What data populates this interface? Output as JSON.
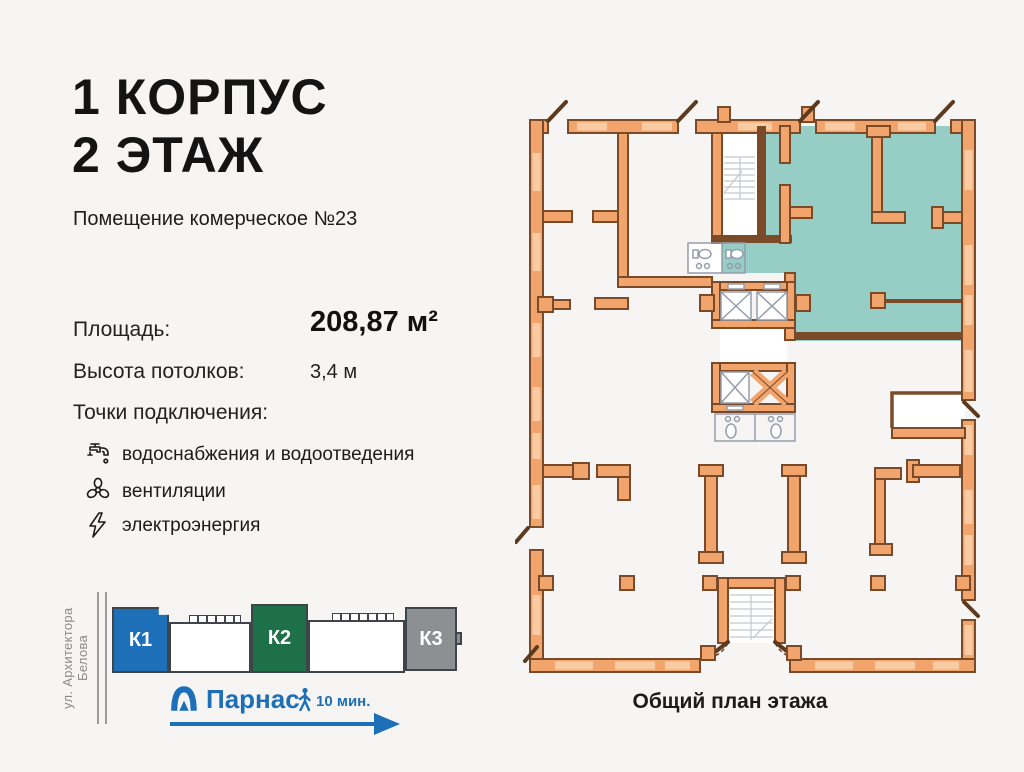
{
  "page": {
    "background": "#F6F5F3"
  },
  "header": {
    "title_line1": "1 КОРПУС",
    "title_line2": "2 ЭТАЖ",
    "subtitle": "Помещение комерческое №23"
  },
  "specs": {
    "area_label": "Площадь:",
    "area_value": "208,87 м²",
    "ceiling_label": "Высота потолков:",
    "ceiling_value": "3,4 м",
    "connections_label": "Точки подключения:",
    "connections": [
      {
        "icon": "faucet-icon",
        "label": "водоснабжения и водоотведения"
      },
      {
        "icon": "fan-icon",
        "label": "вентиляции"
      },
      {
        "icon": "lightning-icon",
        "label": "электроэнергия"
      }
    ]
  },
  "location": {
    "street": "ул. Архитектора Белова",
    "buildings": [
      {
        "label": "К1",
        "color": "#1D6FB8"
      },
      {
        "label": "К2",
        "color": "#1E7048"
      },
      {
        "label": "К3",
        "color": "#8C9093"
      }
    ],
    "metro": {
      "name": "Парнас",
      "walk_time": "10 мин.",
      "color": "#1D6FB8"
    }
  },
  "plan": {
    "caption": "Общий план этажа",
    "highlight_color": "#96CDC4",
    "wall_color": "#F2A46D",
    "wall_outline": "#7B4A28",
    "window_color": "#F9CBA3"
  }
}
